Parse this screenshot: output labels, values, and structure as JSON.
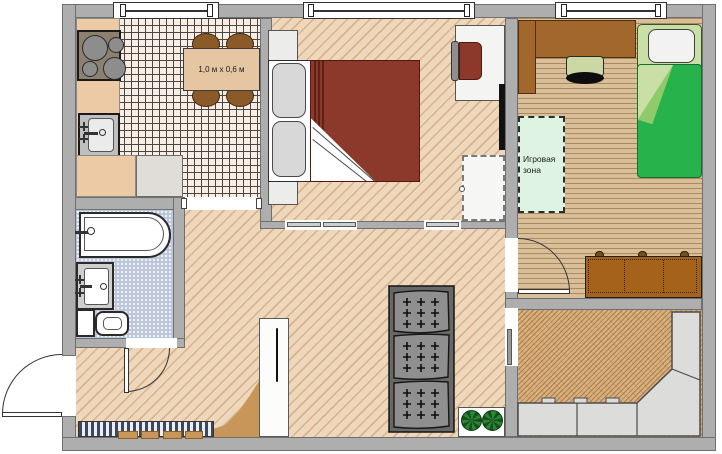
{
  "plan": {
    "labels": {
      "kitchen_table_size": "1,0 м x 0,6 м",
      "play_zone": "Игровая зона"
    },
    "colors": {
      "wall": "#aeaeae",
      "wall_border": "#6f6f6f",
      "hall_bedroom_floor": "#eed7bb",
      "kitchen_tile_floor": "#f9ece3",
      "kids_room_floor": "#d8bf9a",
      "living_room_floor": "#d9b17f",
      "bathroom_floor": "#bdc7db",
      "bedroom_blanket": "#8c392b",
      "kids_blanket": "#27b24b",
      "kids_bed_frame": "#c9dfa6",
      "play_zone_fill": "#def3e2",
      "wood_furniture": "#a2672c",
      "dining_chair": "#8a5a28",
      "dark_sofa_cushion": "#8f8f8f",
      "corner_sofa": "#dcdcda",
      "doormat_stripe": "#3d4763",
      "plant_green": "#2c8435",
      "entry_unit_tan": "#c9965a"
    },
    "icons": [
      "window-icon",
      "door-swing-icon",
      "sliding-door-icon",
      "plant-icon",
      "stove-burner-icon",
      "faucet-icon"
    ]
  }
}
